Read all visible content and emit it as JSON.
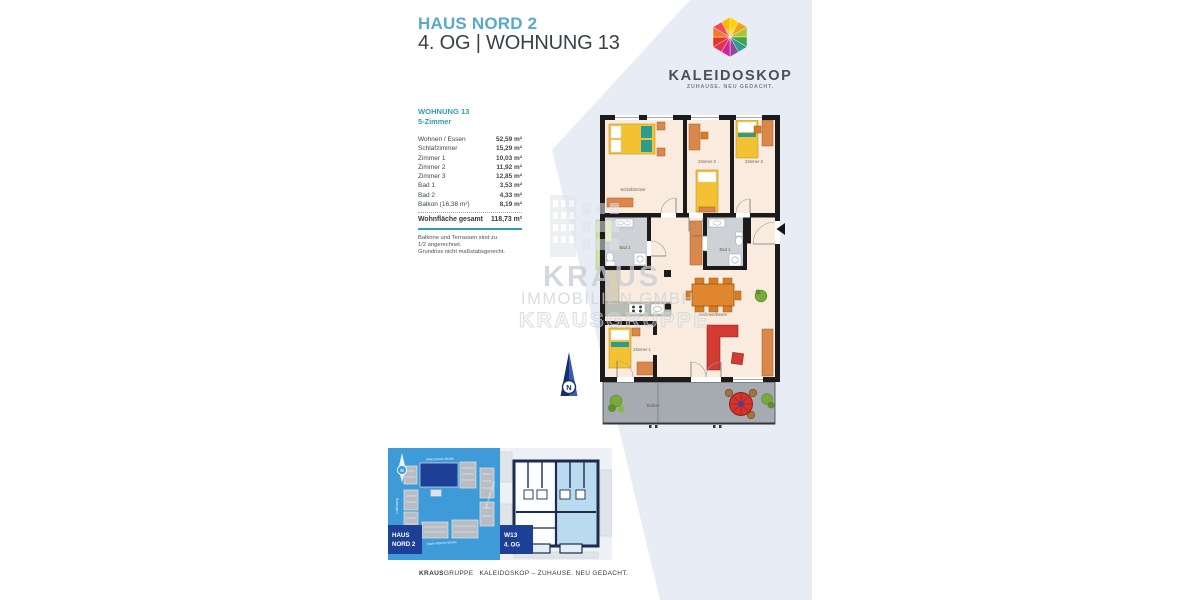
{
  "page": {
    "header": {
      "project": "HAUS NORD 2",
      "unit_line": "4. OG | WOHNUNG 13"
    },
    "logo": {
      "brand": "KALEIDOSKOP",
      "tagline": "ZUHAUSE. NEU GEDACHT."
    },
    "unit": {
      "name": "WOHNUNG 13",
      "type": "5-Zimmer",
      "rooms": [
        {
          "label": "Wohnen / Essen",
          "area": "52,59 m²"
        },
        {
          "label": "Schlafzimmer",
          "area": "15,29 m²"
        },
        {
          "label": "Zimmer 1",
          "area": "10,03 m²"
        },
        {
          "label": "Zimmer 2",
          "area": "11,92 m²"
        },
        {
          "label": "Zimmer 3",
          "area": "12,85 m²"
        },
        {
          "label": "Bad 1",
          "area": "3,53 m²"
        },
        {
          "label": "Bad 2",
          "area": "4,33 m²"
        },
        {
          "label": "Balkon (16,38 m²)",
          "area": "8,19 m²"
        }
      ],
      "total": {
        "label": "Wohnfläche gesamt",
        "area": "118,73 m²"
      },
      "notes": [
        "Balkone und Terrassen sind zu",
        "1/2 angerechnet.",
        "Grundriss nicht maßstabsgerecht."
      ]
    },
    "floorplan": {
      "labels": {
        "schlafzimmer": "Schlafzimmer",
        "zimmer2": "Zimmer 2",
        "zimmer3": "Zimmer 3",
        "bad2": "Bad 2",
        "bad1": "Bad 1",
        "zimmer1": "Zimmer 1",
        "wohnen_essen": "Wohnen/Essen",
        "balkon": "Balkon"
      }
    },
    "watermark": {
      "line1": "KRAUS",
      "line2": "IMMOBILIEN GMBH",
      "line3": "KRAUSGRUPPE"
    },
    "compass": {
      "label": "N"
    },
    "siteplan": {
      "badge": [
        "HAUS",
        "NORD 2"
      ],
      "north": "N",
      "streets": {
        "top": "Hilde-Domin-Straße",
        "bottom": "Marie-Marcks-Straße",
        "right": "Max-Jarecki-Straße",
        "left": "Lindenweg"
      }
    },
    "overview": {
      "badge": [
        "W13",
        "4. OG"
      ]
    },
    "footer": {
      "brand_bold": "KRAUS",
      "brand_rest": "GRUPPE",
      "text": "KALEIDOSKOP – ZUHAUSE. NEU GEDACHT."
    },
    "colors": {
      "accent_blue": "#58a9cc",
      "teal": "#2e9fb0",
      "navy": "#1e3f96",
      "diagonal": "#e8edf5",
      "siteplan_blue": "#3f9bd7",
      "floor": "#f9ecdf",
      "furniture_orange": "#d9874a",
      "bed_yellow": "#f2c233",
      "sofa_red": "#d23a32"
    }
  }
}
